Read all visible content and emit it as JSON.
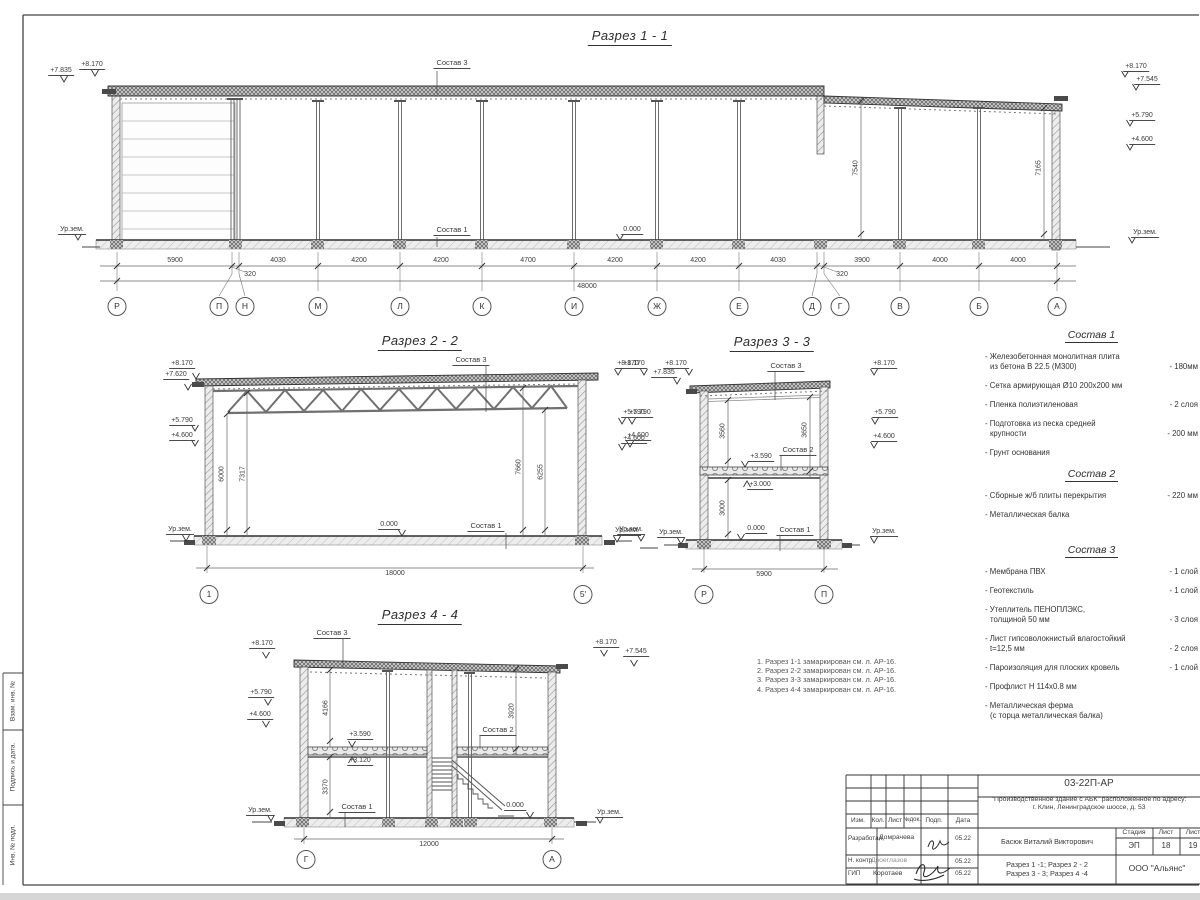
{
  "labels": {
    "ur": "Ур.зем.",
    "zero": "0.000",
    "c1": "Состав 1",
    "c2": "Состав 2",
    "c3": "Состав 3"
  },
  "elev": {
    "e8170": "+8.170",
    "e7835": "+7.835",
    "e7620": "+7.620",
    "e7545": "+7.545",
    "e5790": "+5.790",
    "e4600": "+4.600",
    "e3590": "+3.590",
    "e3120": "+3.120",
    "e3000": "+3.000"
  },
  "s1": {
    "title": "Разрез 1 - 1",
    "vdims": [
      "7540",
      "7165"
    ],
    "dims": [
      "5900",
      "320",
      "4030",
      "4200",
      "4200",
      "4700",
      "4200",
      "4200",
      "4030",
      "320",
      "3900",
      "4000",
      "4000"
    ],
    "total": "48000",
    "axes": [
      "Р",
      "П",
      "Н",
      "М",
      "Л",
      "К",
      "И",
      "Ж",
      "Е",
      "Д",
      "Г",
      "В",
      "Б",
      "А"
    ]
  },
  "s2": {
    "title": "Разрез 2 - 2",
    "vdims": [
      "6000",
      "7317",
      "7660",
      "6255"
    ],
    "dim": "18000",
    "axes": [
      "1",
      "5'"
    ]
  },
  "s3": {
    "title": "Разрез 3 - 3",
    "vdims": [
      "3560",
      "3650",
      "3000"
    ],
    "dim": "5900",
    "axes": [
      "Р",
      "П"
    ]
  },
  "s4": {
    "title": "Разрез 4 - 4",
    "vdims": [
      "4166",
      "3920",
      "3370"
    ],
    "dim": "12000",
    "axes": [
      "Г",
      "А"
    ]
  },
  "notes": [
    "1. Разрез 1-1 замаркирован см. л. АР-16.",
    "2. Разрез 2-2 замаркирован см. л. АР-16.",
    "3. Разрез 3-3 замаркирован см. л. АР-16.",
    "4. Разрез 4-4 замаркирован см. л. АР-16."
  ],
  "mat": {
    "h1": "Состав 1",
    "h2": "Состав 2",
    "h3": "Состав 3",
    "i1": [
      {
        "t": "- Железобетонная  монолитная плита",
        "t2": "из бетона В 22.5 (М300)",
        "q": "- 180мм"
      },
      {
        "t": "- Сетка армирующая Ø10 200х200 мм"
      },
      {
        "t": "- Пленка полиэтиленовая",
        "q": "- 2 слоя"
      },
      {
        "t": "- Подготовка из песка средней",
        "t2": "крупности",
        "q": "- 200 мм"
      },
      {
        "t": "- Грунт основания"
      }
    ],
    "i2": [
      {
        "t": "- Сборные ж/б плиты перекрытия",
        "q": "- 220 мм"
      },
      {
        "t": "- Металлическая балка"
      }
    ],
    "i3": [
      {
        "t": "- Мембрана ПВХ",
        "q": "- 1 слой"
      },
      {
        "t": "- Геотекстиль",
        "q": "- 1 слой"
      },
      {
        "t": "- Утеплитель ПЕНОПЛЭКС,",
        "t2": "толщиной 50 мм",
        "q": "- 3 слоя"
      },
      {
        "t": "- Лист гипсоволокнистый влагостойкий",
        "t2": "t=12,5 мм",
        "q": "- 2 слоя"
      },
      {
        "t": "- Пароизоляция для плоских кровель",
        "q": "- 1 слой"
      },
      {
        "t": "- Профлист Н 114х0.8 мм"
      },
      {
        "t": "- Металлическая ферма",
        "t2": "(с торца металлическая балка)"
      }
    ]
  },
  "stamp": {
    "doc": "03-22П-АР",
    "object1": "\"Производственное здание с АБК\" расположенное по адресу:",
    "object2": "г. Клин, Ленинградское шоссе, д. 53",
    "izm": "Изм.",
    "kol": "Кол.",
    "list": "Лист",
    "ndok": "№док.",
    "podp": "Подп.",
    "data": "Дата",
    "r1": "Разработал",
    "n1": "Домрачева",
    "d1": "05.22",
    "r2": "Н. контр.",
    "n2": "Двоеглазов",
    "d2": "05.22",
    "r3": "ГИП",
    "n3": "Коротаев",
    "d3": "05.22",
    "author": "Басюк Виталий Викторович",
    "t1": "Разрез 1 -1;  Разрез 2 - 2",
    "t2": "Разрез 3 - 3;  Разрез 4 -4",
    "stage_h": "Стадия",
    "sheet_h": "Лист",
    "sheets_h": "Лист",
    "stage": "ЭП",
    "sheet": "18",
    "sheets": "19",
    "company": "ООО \"Альянс\""
  },
  "side": {
    "v1": "Взам. инв. №",
    "v2": "Подпись  и  дата.",
    "v3": "Инв. № подл."
  }
}
